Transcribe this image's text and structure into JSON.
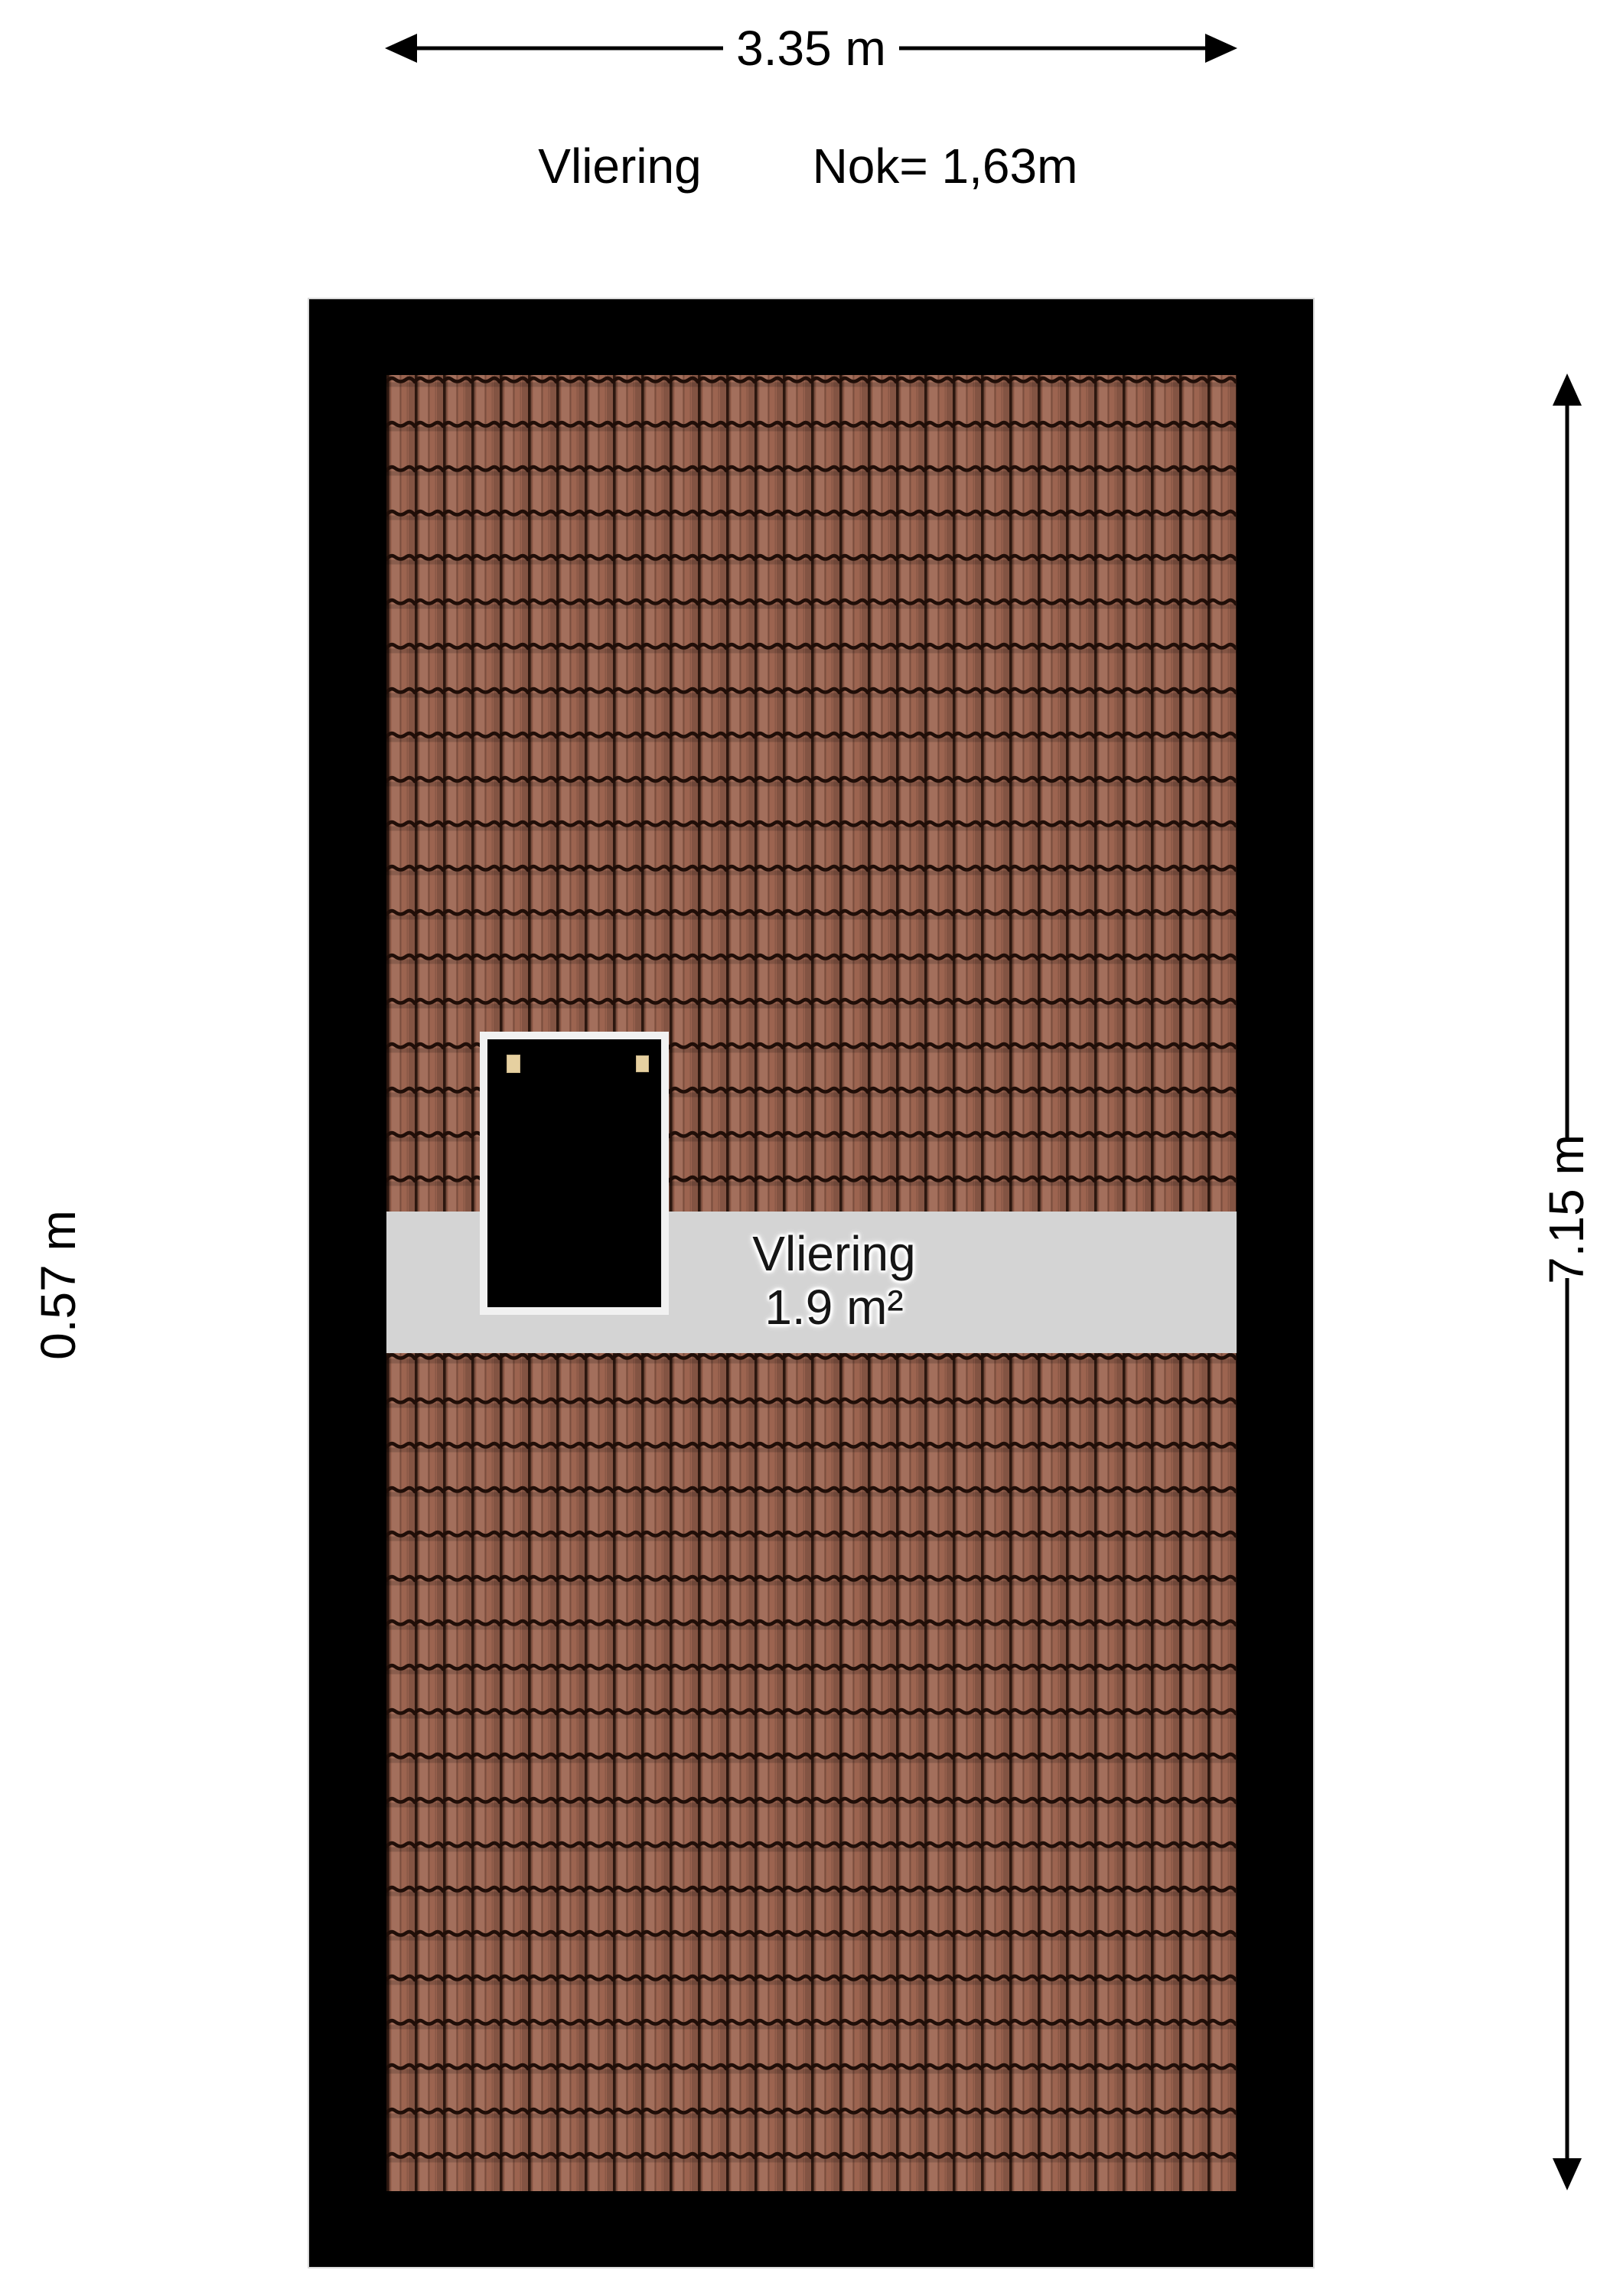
{
  "header": {
    "floor_name": "Vliering",
    "ridge_height": "Nok= 1,63m"
  },
  "dimensions": {
    "top": "3.35 m",
    "right": "7.15 m",
    "left": "0.57 m"
  },
  "room": {
    "name": "Vliering",
    "area": "1.9 m²"
  },
  "colors": {
    "page_bg": "#ffffff",
    "wall": "#000000",
    "roof_tile": "#9c6450",
    "roof_line": "#200e08",
    "band": "#d4d4d4",
    "frame": "#f1f1f1",
    "window": "#000000",
    "hinge": "#e6d0a0",
    "text": "#000000"
  }
}
